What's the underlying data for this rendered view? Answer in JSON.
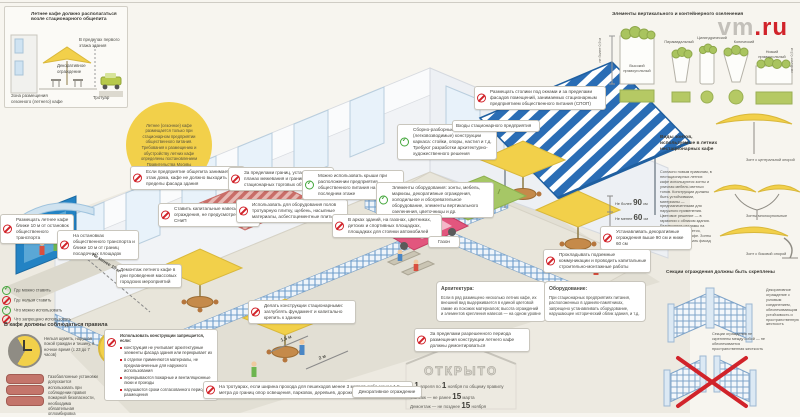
{
  "logo": {
    "gray": "vm",
    "red": ".ru"
  },
  "panel_location": {
    "title": "Летнее кафе должно располагаться возле стационарного общепита",
    "label_floor": "В пределах первого этажа здания",
    "label_fence": "Декоративное ограждение",
    "label_sidewalk": "Тротуар",
    "label_zone": "Зона размещения сезонного (летнего) кафе"
  },
  "intro": {
    "text": "Летнее (сезонное) кафе размещается только при стационарном предприятии общественного питания. Требования к размещению и обустройству летних кафе определены постановлением Правительства Москвы"
  },
  "panel_planters": {
    "title": "Элементы вертикального и контейнерного озеленения",
    "items": [
      "Высокий прямоугольный",
      "Пирамидальный",
      "Цилиндрический",
      "Конический",
      "Низкий прямоугольный"
    ],
    "dim_left": "не более 0,9 м",
    "dim_right": "не более 0,5 м"
  },
  "panel_umbrellas": {
    "title": "Виды зонтов, используемые в летних нестационарных кафе",
    "paragraph": "Согласно новым правилам, в нестационарных летних кафе используются зонты и уличная мебель светлых тонов. Конструкции должны быть устойчивыми, материалы — предназначенными для наружного применения. Цветовое решение — в гармонии с обликом здания. Размещение рекламы на зонтах не допускается, кроме названия кафе. Зонты не должны закрывать фасад и окна здания",
    "items": [
      "Зонт с центральной опорой",
      "Зонты многокупольные",
      "Зонт с боковой опорой"
    ]
  },
  "panel_fences": {
    "title": "Секции ограждения должны быть скреплены",
    "note_ok": "Декоративное ограждение с узловым соединением, обеспечивающим устойчивость и пространственную жесткость",
    "note_bad": "Секции ограждения не скреплены между собой — не обеспечивается пространственная жесткость"
  },
  "open_sign": {
    "word": "ОТКРЫТО",
    "l1a": "С",
    "l1n1": "1",
    "l1b": "апреля по",
    "l1n2": "1",
    "l1c": "ноября по общему правилу",
    "l2a": "Монтаж — не ранее",
    "l2n": "15",
    "l2b": "марта",
    "l3a": "Демонтаж — не позднее",
    "l3n": "15",
    "l3b": "ноября"
  },
  "legend": {
    "items": [
      {
        "label": "Где можно ставить"
      },
      {
        "label": "Где нельзя ставить"
      },
      {
        "label": "Что можно использовать"
      },
      {
        "label": "Что запрещено использовать"
      }
    ]
  },
  "rules": {
    "title": "В кафе должны соблюдаться правила",
    "clock": "Нельзя шуметь, нарушая покой граждан и тишину, в ночное время (с 23 до 7 часов)",
    "cylinders": "Газобаллонные установки допускается использовать при соблюдении правил пожарной безопасности, необходима обязательная опломбировка",
    "bulb": "Можно использовать осветительные приборы, исключая попадание света в окна жилых помещений"
  },
  "arch": {
    "title": "Архитектура:",
    "text": "Если в ряд размещено несколько летних кафе, их внешний вид выдерживается в единой цветовой гамме из похожих материалов; высота ограждений и элементов крепления навесов — на одном уровне"
  },
  "equip": {
    "title": "Оборудование:",
    "text": "При стационарных предприятиях питания, расположенных в зданиях-памятниках, запрещено устанавливать оборудование, нарушающее исторический облик здания, и т.д."
  },
  "restrict_list": {
    "header": "Использовать конструкции запрещается, если:",
    "bullets": [
      "конструкция не учитывает архитектурные элементы фасада здания или перекрывает их",
      "в отделке применяются материалы, не предназначенные для наружного использования",
      "перекрываются пожарные и вентиляционные люки и проезды",
      "нарушаются сроки согласованного периода размещения"
    ]
  },
  "measurements": {
    "ten_m": "Не менее 10 м",
    "w15": "1,5 м",
    "w2": "2 м",
    "h90_pre": "Не более",
    "h90_n": "90",
    "h90_u": "см",
    "h60_pre": "Не менее",
    "h60_n": "60",
    "h60_u": "см",
    "lawn": "Газон",
    "entrances": "Входы стационарного предприятия",
    "fence_label": "Декоративное ограждение"
  },
  "callouts": [
    {
      "text": "Если предприятие общепита занимает 1-й этаж дома, кафе не должно выходить за пределы фасада здания"
    },
    {
      "text": "Ставить капитальные навесы и ограждения, не предусмотренные СНиП"
    },
    {
      "text": "За пределами границ, установленных в планах межевания и границ стационарных торговых объектов"
    },
    {
      "text": "Использовать для оборудования полов тротуарную плитку, щебень, насыпные материалы, асбестоцементные плиты"
    },
    {
      "text": "Можно использовать крыши при расположении предприятия общественного питания на последнем этаже"
    },
    {
      "text": "Сборно-разборные (легковозводимые) конструкции каркаса: стойки, опоры, настил и т.д. Требуют разработки архитектурно-художественного решения"
    },
    {
      "text": "Элементы оборудования: зонты, мебель, маркизы, декоративные ограждения, холодильное и обогревательное оборудование, элементы вертикального озеленения, цветочницы и др."
    },
    {
      "text": "В арках зданий, на газонах, цветниках, детских и спортивных площадках, площадках для стоянки автомобилей"
    },
    {
      "text": "Размещать столики под окнами и за пределами фасадов помещений, занимаемых стационарным предприятием общественного питания (СПОП)"
    },
    {
      "text": "Устанавливать декоративные ограждения выше 90 см и ниже 60 см"
    },
    {
      "text": "Прокладывать подземные коммуникации и проводить капитальные строительно-монтажные работы"
    },
    {
      "text": "Размещать летнее кафе ближе 10 м от остановок общественного транспорта"
    },
    {
      "text": "На остановках общественного транспорта и ближе 10 м от границ посадочных площадок"
    },
    {
      "text": "Демонтаж летнего кафе в дни проведения массовых городских мероприятий"
    },
    {
      "text": "Делать конструкции стационарными: заглублять фундамент и капитально крепить к зданию"
    },
    {
      "text": "На тротуарах, если ширина прохода для пешеходов менее 3 метров либо менее 1,5 метра до границ опор освещения, парковок, деревьев, дорожной разметки и др."
    },
    {
      "text": "За пределами разрешенного периода размещения конструкции летнего кафе должны демонтироваться"
    }
  ]
}
